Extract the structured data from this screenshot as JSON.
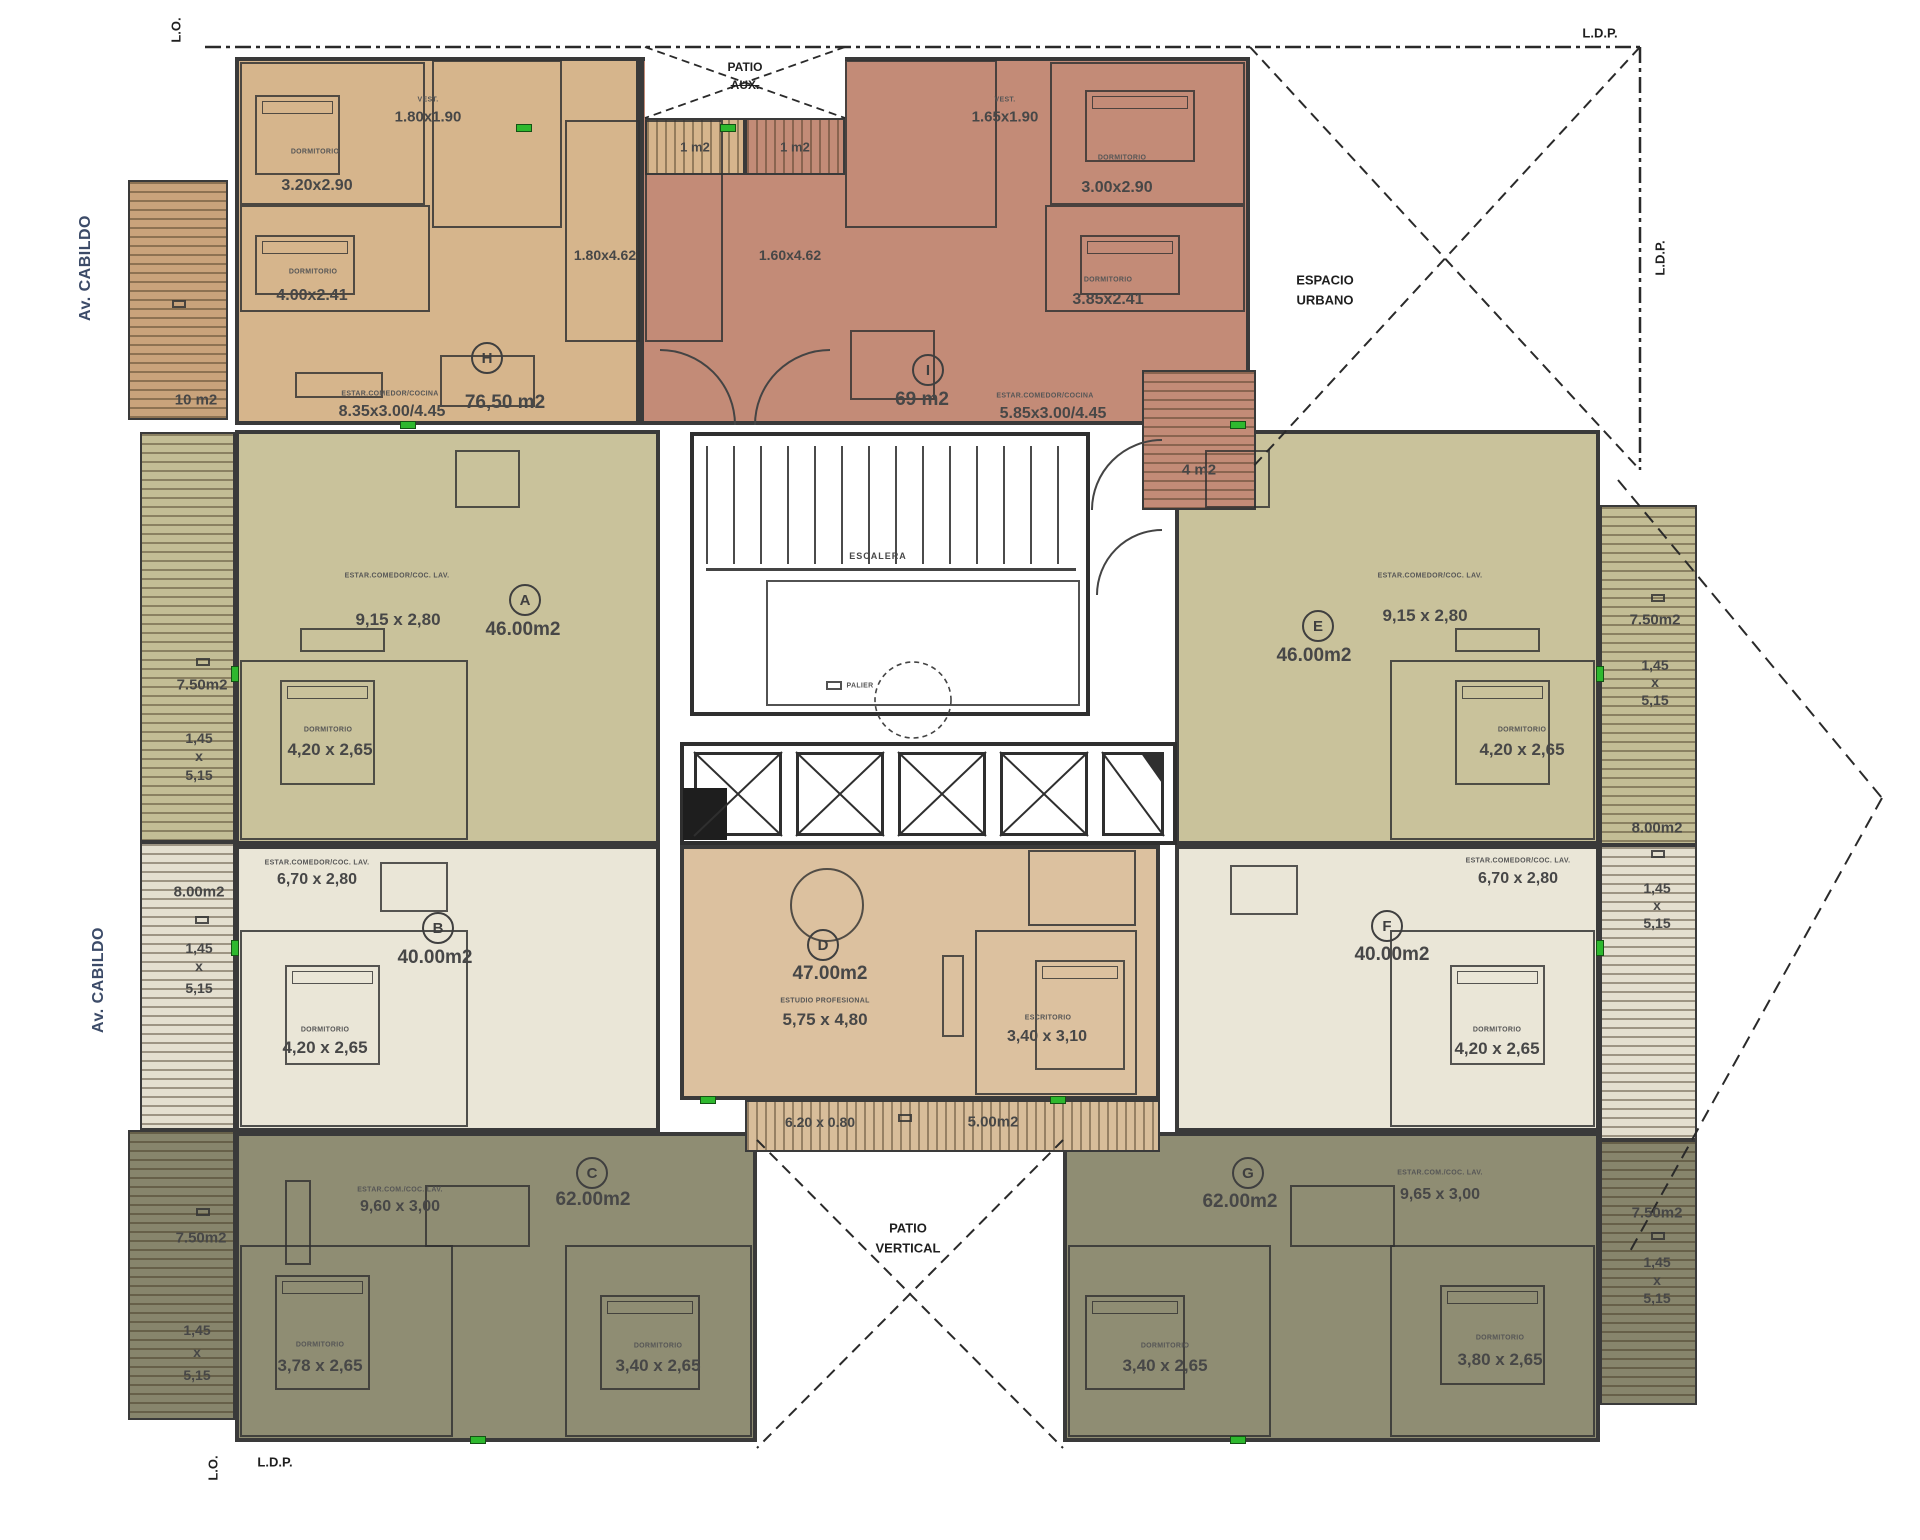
{
  "street": "Av. CABILDO",
  "boundary": {
    "lo": "L.O.",
    "ldp": "L.D.P."
  },
  "open_areas": {
    "espacio_1": "ESPACIO",
    "espacio_2": "URBANO",
    "patio_top_1": "PATIO",
    "patio_top_2": "AUX.",
    "patio_bottom_1": "PATIO",
    "patio_bottom_2": "VERTICAL"
  },
  "core": {
    "stair": "ESCALERA",
    "landing": "PALIER"
  },
  "labels": {
    "dormitorio": "DORMITORIO",
    "vest": "VEST."
  },
  "units": {
    "h": {
      "letter": "H",
      "area": "76,50 m2",
      "vest_dims": "1.80x1.90",
      "dorm1_dims": "3.20x2.90",
      "dorm2_dims": "4.00x2.41",
      "kitchen_dims": "1.80x4.62",
      "living_label": "ESTAR.COMEDOR/COCINA",
      "living_dims": "8.35x3.00/4.45",
      "terrace": "10 m2",
      "patio_balcony": "1 m2"
    },
    "i": {
      "letter": "I",
      "area": "69 m2",
      "vest_dims": "1.65x1.90",
      "dorm1_dims": "3.00x2.90",
      "dorm2_dims": "3.85x2.41",
      "kitchen_dims": "1.60x4.62",
      "living_label": "ESTAR.COMEDOR/COCINA",
      "living_dims": "5.85x3.00/4.45",
      "stair_balcony": "4 m2",
      "patio_balcony": "1 m2"
    },
    "a": {
      "letter": "A",
      "area": "46.00m2",
      "living_label": "ESTAR.COMEDOR/COC. LAV.",
      "living_dims": "9,15 x 2,80",
      "dorm_dims": "4,20 x 2,65"
    },
    "b": {
      "letter": "B",
      "area": "40.00m2",
      "living_label": "ESTAR.COMEDOR/COC. LAV.",
      "living_dims": "6,70 x 2,80",
      "dorm_dims": "4,20 x 2,65"
    },
    "c": {
      "letter": "C",
      "area": "62.00m2",
      "living_label": "ESTAR.COM./COC. LAV.",
      "living_dims": "9,60 x 3,00",
      "dorm1_dims": "3,78 x 2,65",
      "dorm2_dims": "3,40 x 2,65"
    },
    "d": {
      "letter": "D",
      "area": "47.00m2",
      "studio_label": "ESTUDIO PROFESIONAL",
      "studio_dims": "5,75 x 4,80",
      "office_label": "ESCRITORIO",
      "office_dims": "3,40 x 3,10",
      "balcony_dims": "6.20 x 0.80",
      "balcony_area": "5.00m2"
    },
    "e": {
      "letter": "E",
      "area": "46.00m2",
      "living_label": "ESTAR.COMEDOR/COC. LAV.",
      "living_dims": "9,15 x 2,80",
      "dorm_dims": "4,20 x 2,65"
    },
    "f": {
      "letter": "F",
      "area": "40.00m2",
      "living_label": "ESTAR.COMEDOR/COC. LAV.",
      "living_dims": "6,70 x 2,80",
      "dorm_dims": "4,20 x 2,65"
    },
    "g": {
      "letter": "G",
      "area": "62.00m2",
      "living_label": "ESTAR.COM./COC. LAV.",
      "living_dims": "9,65 x 3,00",
      "dorm1_dims": "3,40 x 2,65",
      "dorm2_dims": "3,80 x 2,65"
    }
  },
  "balconies": {
    "left_a": {
      "area": "7.50m2",
      "w": "1,45",
      "sep": "x",
      "l": "5,15"
    },
    "left_b": {
      "area": "8.00m2",
      "w": "1,45",
      "sep": "x",
      "l": "5,15"
    },
    "left_c": {
      "area": "7.50m2",
      "w": "1,45",
      "sep": "x",
      "l": "5,15"
    },
    "right_e": {
      "area": "7.50m2",
      "w": "1,45",
      "sep": "x",
      "l": "5,15"
    },
    "right_f": {
      "area": "8.00m2",
      "w": "1,45",
      "sep": "x",
      "l": "5,15"
    },
    "right_g": {
      "area": "7.50m2",
      "w": "1,45",
      "sep": "x",
      "l": "5,15"
    }
  },
  "colors": {
    "unit_h": "#d6b58c",
    "unit_i": "#c38b77",
    "unit_ae": "#c9c29b",
    "unit_bf": "#eae6d7",
    "unit_cg": "#8f8d73",
    "unit_d": "#dcc19f",
    "accent_green": "#2eb82e",
    "street_label": "#3c4b68"
  }
}
